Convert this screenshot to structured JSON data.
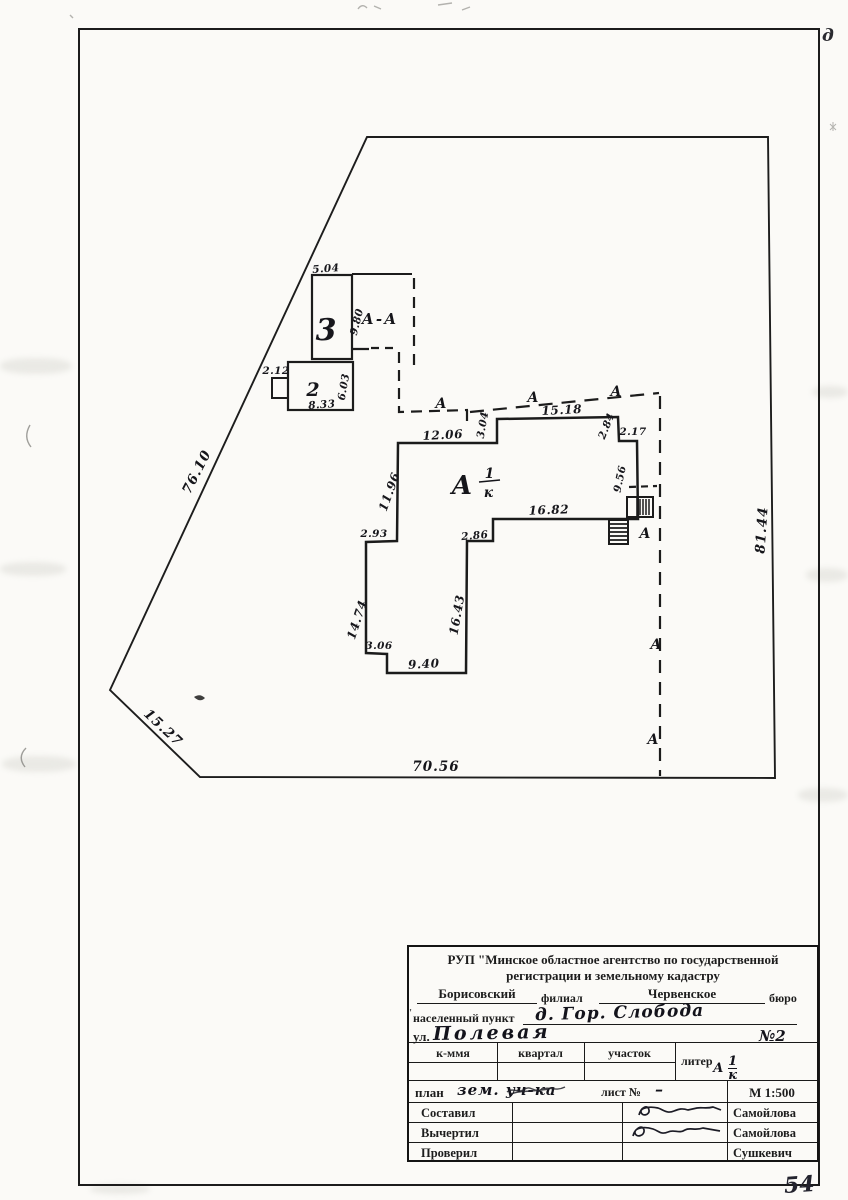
{
  "page": {
    "number": "54",
    "corner_mark": "д",
    "stray_mark": "'"
  },
  "drawing": {
    "parcel": {
      "left": "76.10",
      "left_lower": "15.27",
      "bottom": "70.56",
      "right": "81.44"
    },
    "building3": {
      "label": "3",
      "width": "5.04",
      "height": "9.80"
    },
    "building2": {
      "label": "2",
      "porch_width": "2.12",
      "width": "8.33",
      "height": "6.03"
    },
    "section_label": "А-А",
    "section_mark": "А",
    "main": {
      "letter": "А",
      "num": "1",
      "den": "к",
      "top1": "12.06",
      "step_top": "3.04",
      "top2": "15.18",
      "right1": "2.84",
      "right_step": "2.17",
      "right2": "9.56",
      "left1": "11.96",
      "bottom_inner": "16.82",
      "step_left": "2.93",
      "step_right": "2.86",
      "left2": "14.74",
      "inner_right": "16.43",
      "step_bottom": "3.06",
      "bottom": "9.40"
    }
  },
  "titleblock": {
    "agency_line1": "РУП \"Минское областное агентство по государственной",
    "agency_line2": "регистрации и земельному кадастру",
    "branch_name": "Борисовский",
    "branch_label": "филиал",
    "bureau_name": "Червенское",
    "bureau_label": "бюро",
    "settlement_label": "населенный пункт",
    "settlement_value": "д. Гор. Слобода",
    "street_label": "ул.",
    "street_value": "Полевая",
    "house_no": "№2",
    "col_kmya": "к-ммя",
    "col_kvartal": "квартал",
    "col_uchastok": "участок",
    "liter_label": "литер",
    "liter_letter": "А",
    "liter_num": "1",
    "liter_den": "к",
    "plan_label": "план",
    "plan_value": "зем. уч-ка",
    "sheet_label": "лист №",
    "sheet_value": "–",
    "scale": "М 1:500",
    "row_sostavil": "Составил",
    "row_vychertil": "Вычертил",
    "row_proveril": "Проверил",
    "name_sostavil": "Самойлова",
    "name_vychertil": "Самойлова",
    "name_proveril": "Сушкевич"
  }
}
